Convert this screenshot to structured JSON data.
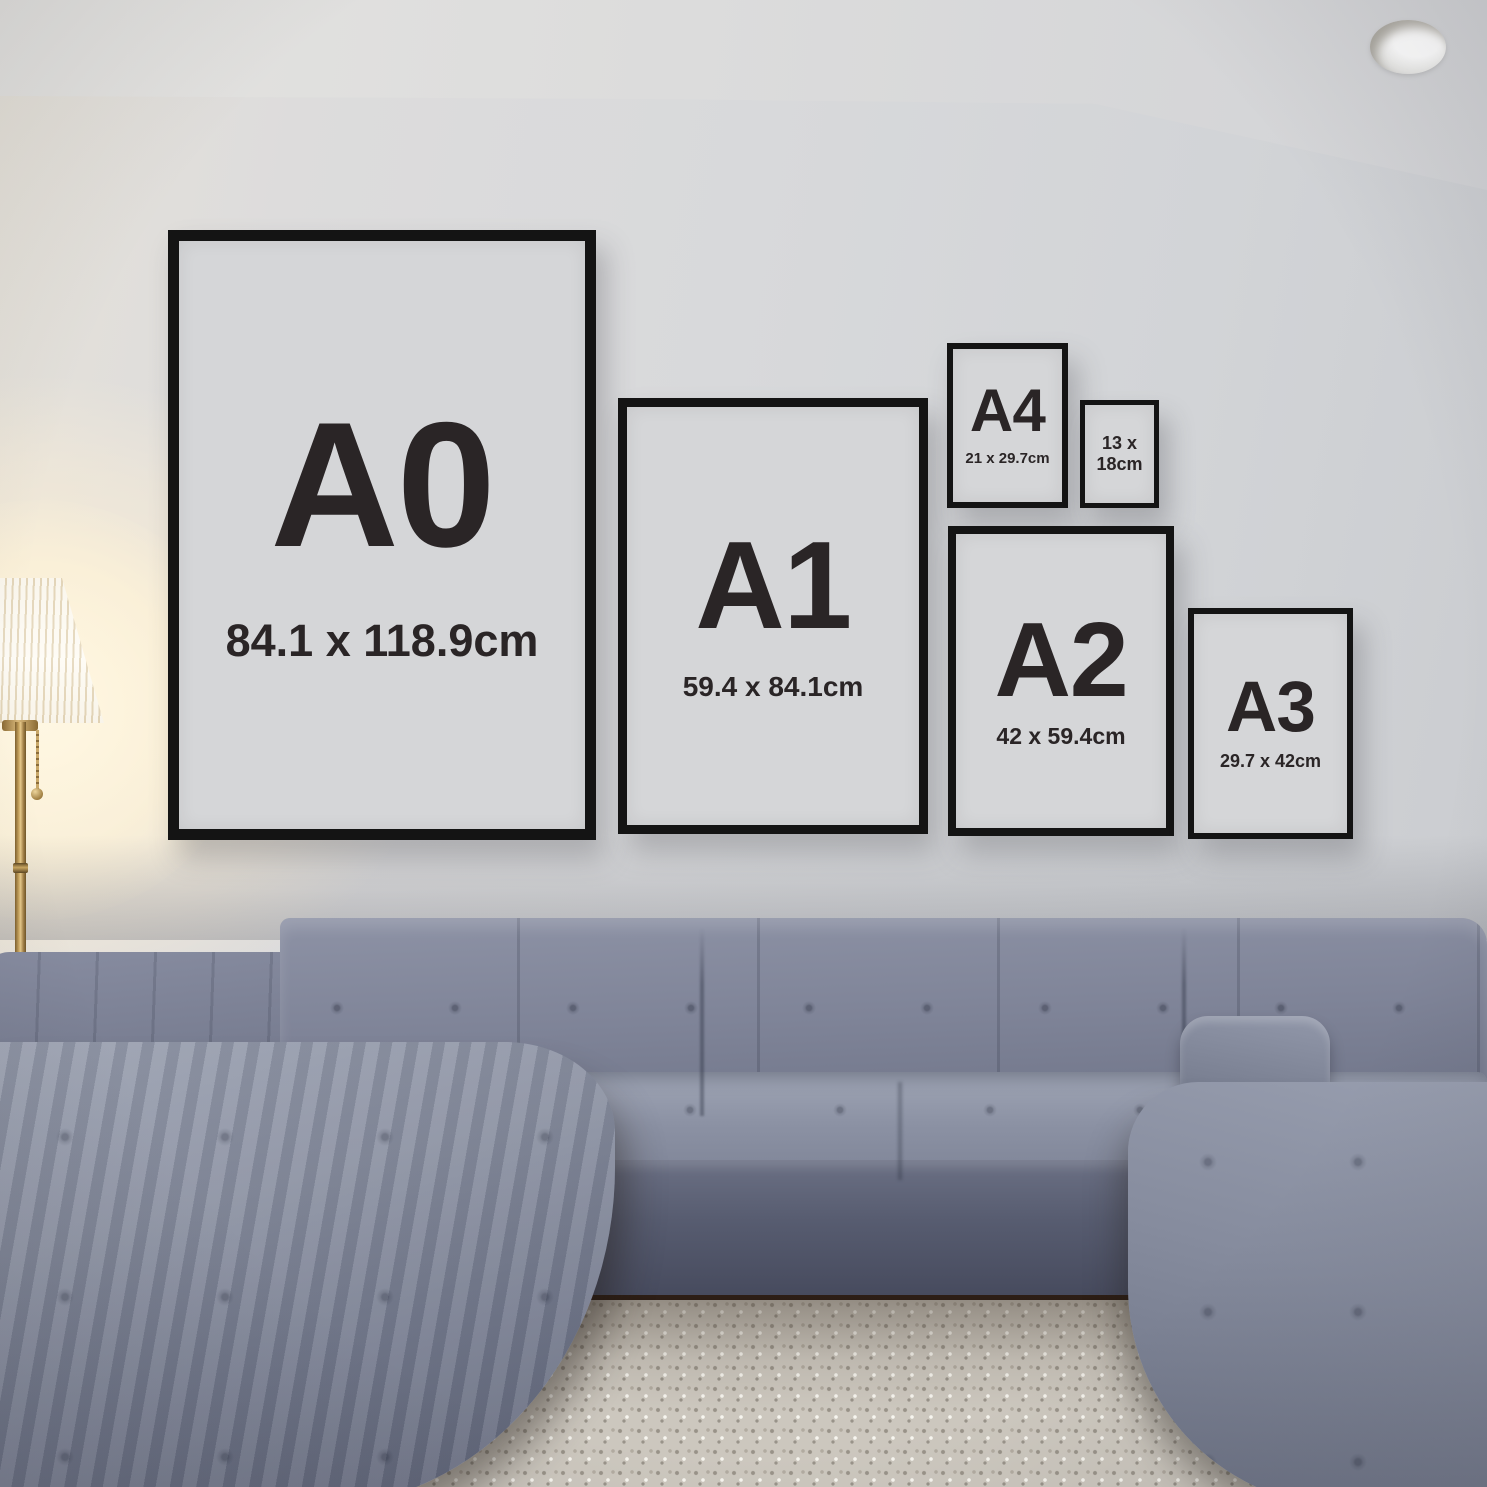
{
  "frames": [
    {
      "name": "A0",
      "size_label": "A0",
      "dimensions": "84.1 x 118.9cm"
    },
    {
      "name": "A1",
      "size_label": "A1",
      "dimensions": "59.4 x 84.1cm"
    },
    {
      "name": "A4",
      "size_label": "A4",
      "dimensions": "21 x 29.7cm"
    },
    {
      "name": "13x18",
      "dimensions_line1": "13 x",
      "dimensions_line2": "18cm"
    },
    {
      "name": "A2",
      "size_label": "A2",
      "dimensions": "42 x 59.4cm"
    },
    {
      "name": "A3",
      "size_label": "A3",
      "dimensions": "29.7 x 42cm"
    }
  ],
  "colors": {
    "frame_border": "#141414",
    "paper": "#d5d6d8",
    "text_dark": "#2a2526",
    "wall": "#d6d7d9",
    "ceiling": "#dcdcdc",
    "sofa_light": "#9fa5b5",
    "sofa_mid": "#7e8396",
    "sofa_dark": "#4a4f62",
    "rug": "#ccc7be",
    "lamp_glow": "#fff1d6",
    "lamp_brass": "#b28c50",
    "lamp_shade": "#fdf8ea",
    "floor_dark": "#2e1f16"
  }
}
